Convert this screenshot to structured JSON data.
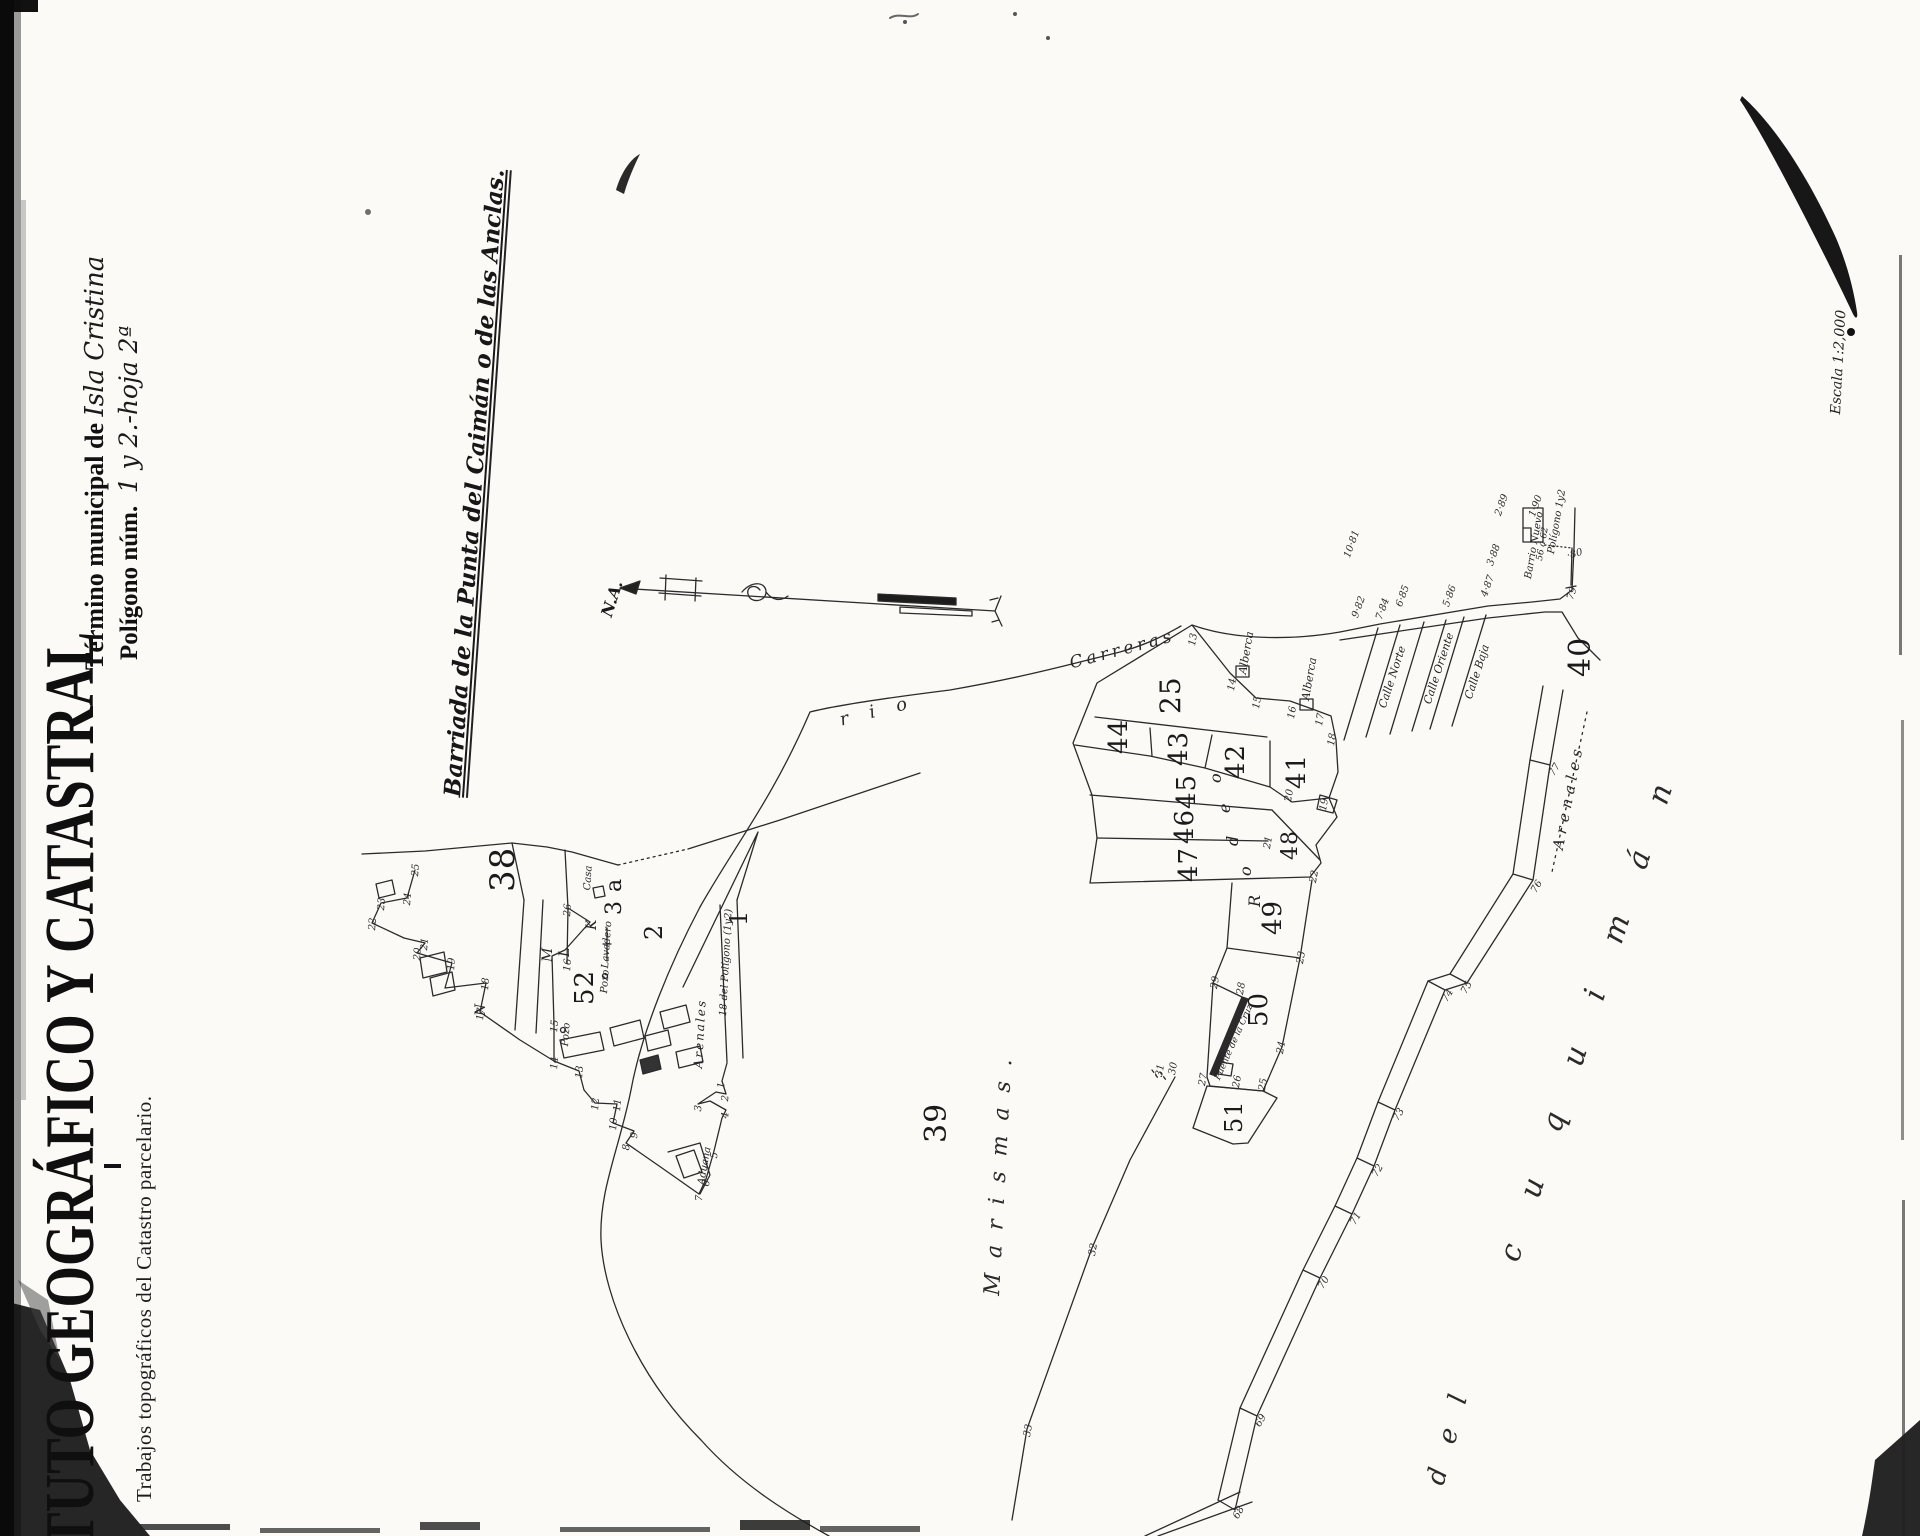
{
  "header": {
    "institute_title_partial": "TUTO GEOGRÁFICO Y CATASTRAL",
    "institute_subtitle": "Trabajos topográficos del Catastro parcelario.",
    "municipality_label": "Término municipal de ",
    "municipality_value": "Isla Cristina",
    "polygon_label": "Polígono núm.  ",
    "polygon_value": "1 y 2.-hoja 2ª",
    "map_area_title": "Barriada de la Punta del Caimán o de las Anclas.",
    "scale_note": "Escala 1:2,000",
    "north_label": "N.A."
  },
  "river": {
    "name_part1": "rio",
    "name_part2": "Carreras"
  },
  "street_names": [
    "Calle Norte",
    "Calle Oriente",
    "Calle Baja"
  ],
  "area_names": [
    "Marismas.",
    "Arenales",
    "del",
    "cuquimán"
  ],
  "labels": [
    {
      "name": "parcel-number-38",
      "text": "38",
      "x": 486,
      "y": 892,
      "rot": -90,
      "fs": 34,
      "cls": "parcel"
    },
    {
      "name": "parcel-number-52",
      "text": "52",
      "x": 572,
      "y": 1005,
      "rot": -90,
      "fs": 26,
      "cls": "parcel"
    },
    {
      "name": "parcel-number-2",
      "text": "2",
      "x": 642,
      "y": 940,
      "rot": -90,
      "fs": 24,
      "cls": "parcel"
    },
    {
      "name": "parcel-number-1",
      "text": "1",
      "x": 727,
      "y": 926,
      "rot": -90,
      "fs": 24,
      "cls": "parcel"
    },
    {
      "name": "parcel-number-3a",
      "text": "3 a",
      "x": 604,
      "y": 915,
      "rot": -90,
      "fs": 22,
      "cls": "parcel"
    },
    {
      "name": "parcel-number-39",
      "text": "39",
      "x": 922,
      "y": 1143,
      "rot": -90,
      "fs": 30,
      "cls": "parcel"
    },
    {
      "name": "parcel-number-25",
      "text": "25",
      "x": 1157,
      "y": 714,
      "rot": -90,
      "fs": 28,
      "cls": "parcel"
    },
    {
      "name": "parcel-number-44",
      "text": "44",
      "x": 1106,
      "y": 754,
      "rot": -90,
      "fs": 26,
      "cls": "parcel"
    },
    {
      "name": "parcel-number-43",
      "text": "43",
      "x": 1166,
      "y": 766,
      "rot": -90,
      "fs": 26,
      "cls": "parcel"
    },
    {
      "name": "parcel-number-42",
      "text": "42",
      "x": 1223,
      "y": 779,
      "rot": -90,
      "fs": 26,
      "cls": "parcel"
    },
    {
      "name": "parcel-number-41",
      "text": "41",
      "x": 1284,
      "y": 789,
      "rot": -90,
      "fs": 26,
      "cls": "parcel"
    },
    {
      "name": "parcel-number-45",
      "text": "45",
      "x": 1174,
      "y": 809,
      "rot": -90,
      "fs": 26,
      "cls": "parcel"
    },
    {
      "name": "parcel-number-46",
      "text": "46",
      "x": 1172,
      "y": 844,
      "rot": -90,
      "fs": 26,
      "cls": "parcel"
    },
    {
      "name": "parcel-number-47",
      "text": "47",
      "x": 1176,
      "y": 882,
      "rot": -90,
      "fs": 26,
      "cls": "parcel"
    },
    {
      "name": "parcel-number-48",
      "text": "48",
      "x": 1280,
      "y": 860,
      "rot": -90,
      "fs": 22,
      "cls": "parcel"
    },
    {
      "name": "parcel-number-49",
      "text": "49",
      "x": 1260,
      "y": 935,
      "rot": -90,
      "fs": 26,
      "cls": "parcel"
    },
    {
      "name": "parcel-number-50",
      "text": "50",
      "x": 1246,
      "y": 1027,
      "rot": -90,
      "fs": 26,
      "cls": "parcel"
    },
    {
      "name": "parcel-number-51",
      "text": "51",
      "x": 1222,
      "y": 1133,
      "rot": -90,
      "fs": 24,
      "cls": "parcel"
    },
    {
      "name": "parcel-number-40",
      "text": "40",
      "x": 1566,
      "y": 677,
      "rot": -90,
      "fs": 30,
      "cls": "parcel"
    },
    {
      "name": "subparcel-letter-o",
      "text": "o",
      "x": 1208,
      "y": 783,
      "rot": -90,
      "fs": 16,
      "cls": "letter"
    },
    {
      "name": "subparcel-letter-e",
      "text": "e",
      "x": 1217,
      "y": 813,
      "rot": -90,
      "fs": 16,
      "cls": "letter"
    },
    {
      "name": "subparcel-letter-d",
      "text": "d",
      "x": 1225,
      "y": 846,
      "rot": -90,
      "fs": 16,
      "cls": "letter"
    },
    {
      "name": "subparcel-letter-o2",
      "text": "o",
      "x": 1238,
      "y": 876,
      "rot": -90,
      "fs": 16,
      "cls": "letter"
    },
    {
      "name": "subparcel-letter-R",
      "text": "R",
      "x": 1247,
      "y": 907,
      "rot": -90,
      "fs": 16,
      "cls": "letter"
    },
    {
      "name": "corner-letter-K",
      "text": "K",
      "x": 585,
      "y": 930,
      "rot": -90,
      "fs": 14,
      "cls": "letter"
    },
    {
      "name": "corner-letter-L",
      "text": "L",
      "x": 558,
      "y": 957,
      "rot": -90,
      "fs": 14,
      "cls": "letter"
    },
    {
      "name": "corner-letter-M",
      "text": "M",
      "x": 541,
      "y": 962,
      "rot": -90,
      "fs": 14,
      "cls": "letter"
    },
    {
      "name": "corner-letter-N",
      "text": "N",
      "x": 474,
      "y": 1016,
      "rot": -90,
      "fs": 14,
      "cls": "letter"
    },
    {
      "name": "river-name-rio",
      "text": "r i o",
      "x": 838,
      "y": 712,
      "rot": -14,
      "fs": 18,
      "ls": 8,
      "cls": "spread"
    },
    {
      "name": "river-name-carreras",
      "text": "Carreras",
      "x": 1068,
      "y": 656,
      "rot": -15,
      "fs": 17,
      "ls": 4,
      "cls": "spread"
    },
    {
      "name": "area-marismas",
      "text": "Marismas.",
      "x": 982,
      "y": 1295,
      "rot": -87,
      "fs": 22,
      "ls": 15,
      "cls": "spread"
    },
    {
      "name": "area-arenales-road",
      "text": "Arenales",
      "x": 1551,
      "y": 848,
      "rot": -79,
      "fs": 15,
      "ls": 5,
      "cls": "spread"
    },
    {
      "name": "street-arenales-village",
      "text": "Arenales",
      "x": 692,
      "y": 1068,
      "rot": -87,
      "fs": 12,
      "ls": 2,
      "cls": "place"
    },
    {
      "name": "area-del",
      "text": "del",
      "x": 1423,
      "y": 1481,
      "rot": -75,
      "fs": 26,
      "ls": 26,
      "cls": "spread"
    },
    {
      "name": "area-cuquiman",
      "text": "cuquimán",
      "x": 1495,
      "y": 1256,
      "rot": -72,
      "fs": 30,
      "ls": 50,
      "cls": "spread"
    },
    {
      "name": "label-alberca-1",
      "text": "Alberca",
      "x": 1237,
      "y": 673,
      "rot": -80,
      "fs": 11,
      "cls": "place"
    },
    {
      "name": "label-alberca-2",
      "text": "Alberca",
      "x": 1300,
      "y": 699,
      "rot": -80,
      "fs": 11,
      "cls": "place"
    },
    {
      "name": "label-casa",
      "text": "Casa",
      "x": 583,
      "y": 890,
      "rot": -86,
      "fs": 10,
      "cls": "place"
    },
    {
      "name": "label-pozo-1",
      "text": "Pozo",
      "x": 600,
      "y": 993,
      "rot": -86,
      "fs": 10,
      "cls": "place"
    },
    {
      "name": "label-pozo-2",
      "text": "Pozo",
      "x": 561,
      "y": 1046,
      "rot": -86,
      "fs": 10,
      "cls": "place"
    },
    {
      "name": "label-lavadero",
      "text": "Lavadero",
      "x": 601,
      "y": 968,
      "rot": -86,
      "fs": 10,
      "cls": "place"
    },
    {
      "name": "label-aduana",
      "text": "Aduana",
      "x": 697,
      "y": 1184,
      "rot": -80,
      "fs": 10,
      "cls": "place"
    },
    {
      "name": "label-road-poligono",
      "text": "18 del Polígono (1y2)",
      "x": 719,
      "y": 1016,
      "rot": -87,
      "fs": 10,
      "cls": "place"
    },
    {
      "name": "label-barrio-nuevo",
      "text": "Barrio Nuevo",
      "x": 1524,
      "y": 578,
      "rot": -80,
      "fs": 10,
      "cls": "place"
    },
    {
      "name": "label-barrio-range",
      "text": "56 á 62",
      "x": 1536,
      "y": 560,
      "rot": -80,
      "fs": 9,
      "cls": "place"
    },
    {
      "name": "label-barrio-poligono",
      "text": "Polígono 1y2",
      "x": 1547,
      "y": 553,
      "rot": -80,
      "fs": 10,
      "cls": "place"
    },
    {
      "name": "label-pier",
      "text": "Puente de la Cruz",
      "x": 1214,
      "y": 1078,
      "rot": -66,
      "fs": 9,
      "cls": "place"
    },
    {
      "name": "street-calle-norte",
      "text": "Calle Norte",
      "x": 1377,
      "y": 706,
      "rot": -72,
      "fs": 11,
      "cls": "place"
    },
    {
      "name": "street-calle-oriente",
      "text": "Calle Oriente",
      "x": 1422,
      "y": 702,
      "rot": -72,
      "fs": 11,
      "cls": "place"
    },
    {
      "name": "street-calle-baja",
      "text": "Calle Baja",
      "x": 1463,
      "y": 697,
      "rot": -72,
      "fs": 11,
      "cls": "place"
    },
    {
      "name": "road-point-10-81",
      "text": "10·81",
      "x": 1343,
      "y": 556,
      "rot": -70,
      "fs": 10,
      "cls": "vnum"
    },
    {
      "name": "road-point-9-82",
      "text": "9·82",
      "x": 1351,
      "y": 616,
      "rot": -70,
      "fs": 10,
      "cls": "vnum"
    },
    {
      "name": "road-point-7-84",
      "text": "7·84",
      "x": 1375,
      "y": 618,
      "rot": -70,
      "fs": 10,
      "cls": "vnum"
    },
    {
      "name": "road-point-6-85",
      "text": "6·85",
      "x": 1395,
      "y": 605,
      "rot": -70,
      "fs": 10,
      "cls": "vnum"
    },
    {
      "name": "road-point-5-86",
      "text": "5·86",
      "x": 1442,
      "y": 605,
      "rot": -70,
      "fs": 10,
      "cls": "vnum"
    },
    {
      "name": "road-point-4-87",
      "text": "4·87",
      "x": 1480,
      "y": 595,
      "rot": -70,
      "fs": 10,
      "cls": "vnum"
    },
    {
      "name": "road-point-3-88",
      "text": "3·88",
      "x": 1486,
      "y": 564,
      "rot": -70,
      "fs": 10,
      "cls": "vnum"
    },
    {
      "name": "road-point-2-89",
      "text": "2·89",
      "x": 1494,
      "y": 514,
      "rot": -70,
      "fs": 10,
      "cls": "vnum"
    },
    {
      "name": "road-point-1-90",
      "text": "1·90",
      "x": 1528,
      "y": 515,
      "rot": -70,
      "fs": 10,
      "cls": "vnum"
    },
    {
      "name": "road-point-80",
      "text": "·80",
      "x": 1566,
      "y": 552,
      "rot": -15,
      "fs": 10,
      "cls": "vnum"
    },
    {
      "name": "road-point-79",
      "text": "79",
      "x": 1566,
      "y": 598,
      "rot": -70,
      "fs": 10,
      "cls": "vnum"
    },
    {
      "name": "road-point-77",
      "text": "77",
      "x": 1548,
      "y": 773,
      "rot": -60,
      "fs": 10,
      "cls": "vnum"
    },
    {
      "name": "road-point-76",
      "text": "76",
      "x": 1530,
      "y": 890,
      "rot": -60,
      "fs": 10,
      "cls": "vnum"
    },
    {
      "name": "road-point-75",
      "text": "75",
      "x": 1460,
      "y": 991,
      "rot": -60,
      "fs": 10,
      "cls": "vnum"
    },
    {
      "name": "road-point-74",
      "text": "74",
      "x": 1441,
      "y": 999,
      "rot": -60,
      "fs": 10,
      "cls": "vnum"
    },
    {
      "name": "road-point-73",
      "text": "73",
      "x": 1392,
      "y": 1118,
      "rot": -60,
      "fs": 10,
      "cls": "vnum"
    },
    {
      "name": "road-point-72",
      "text": "72",
      "x": 1371,
      "y": 1174,
      "rot": -60,
      "fs": 10,
      "cls": "vnum"
    },
    {
      "name": "road-point-71",
      "text": "71",
      "x": 1349,
      "y": 1222,
      "rot": -60,
      "fs": 10,
      "cls": "vnum"
    },
    {
      "name": "road-point-70",
      "text": "70",
      "x": 1317,
      "y": 1286,
      "rot": -60,
      "fs": 10,
      "cls": "vnum"
    },
    {
      "name": "road-point-69",
      "text": "69",
      "x": 1254,
      "y": 1424,
      "rot": -60,
      "fs": 10,
      "cls": "vnum"
    },
    {
      "name": "road-point-68",
      "text": "68",
      "x": 1232,
      "y": 1516,
      "rot": -60,
      "fs": 10,
      "cls": "vnum"
    },
    {
      "name": "vertex-13",
      "text": "13",
      "x": 1188,
      "y": 645,
      "rot": -80,
      "fs": 10,
      "cls": "vnum"
    },
    {
      "name": "vertex-14",
      "text": "14",
      "x": 1227,
      "y": 690,
      "rot": -80,
      "fs": 10,
      "cls": "vnum"
    },
    {
      "name": "vertex-15",
      "text": "15",
      "x": 1252,
      "y": 708,
      "rot": -80,
      "fs": 10,
      "cls": "vnum"
    },
    {
      "name": "vertex-16",
      "text": "16",
      "x": 1287,
      "y": 718,
      "rot": -80,
      "fs": 10,
      "cls": "vnum"
    },
    {
      "name": "vertex-17",
      "text": "17",
      "x": 1315,
      "y": 725,
      "rot": -80,
      "fs": 10,
      "cls": "vnum"
    },
    {
      "name": "vertex-18",
      "text": "18",
      "x": 1327,
      "y": 745,
      "rot": -80,
      "fs": 10,
      "cls": "vnum"
    },
    {
      "name": "vertex-20",
      "text": "20",
      "x": 1284,
      "y": 801,
      "rot": -80,
      "fs": 10,
      "cls": "vnum"
    },
    {
      "name": "vertex-19",
      "text": "19",
      "x": 1319,
      "y": 810,
      "rot": -80,
      "fs": 10,
      "cls": "vnum"
    },
    {
      "name": "vertex-21",
      "text": "21",
      "x": 1263,
      "y": 848,
      "rot": -80,
      "fs": 10,
      "cls": "vnum"
    },
    {
      "name": "vertex-22",
      "text": "22",
      "x": 1309,
      "y": 882,
      "rot": -80,
      "fs": 10,
      "cls": "vnum"
    },
    {
      "name": "vertex-23",
      "text": "23",
      "x": 1296,
      "y": 963,
      "rot": -80,
      "fs": 10,
      "cls": "vnum"
    },
    {
      "name": "vertex-24",
      "text": "24",
      "x": 1276,
      "y": 1053,
      "rot": -80,
      "fs": 10,
      "cls": "vnum"
    },
    {
      "name": "vertex-25",
      "text": "25",
      "x": 1258,
      "y": 1090,
      "rot": -80,
      "fs": 10,
      "cls": "vnum"
    },
    {
      "name": "vertex-26",
      "text": "26",
      "x": 1232,
      "y": 1087,
      "rot": -80,
      "fs": 10,
      "cls": "vnum"
    },
    {
      "name": "vertex-27",
      "text": "27",
      "x": 1198,
      "y": 1085,
      "rot": -80,
      "fs": 10,
      "cls": "vnum"
    },
    {
      "name": "vertex-28",
      "text": "28",
      "x": 1236,
      "y": 994,
      "rot": -80,
      "fs": 10,
      "cls": "vnum"
    },
    {
      "name": "vertex-29",
      "text": "29",
      "x": 1210,
      "y": 988,
      "rot": -80,
      "fs": 10,
      "cls": "vnum"
    },
    {
      "name": "vertex-30",
      "text": "30",
      "x": 1168,
      "y": 1074,
      "rot": -80,
      "fs": 10,
      "cls": "vnum"
    },
    {
      "name": "vertex-31",
      "text": "31",
      "x": 1155,
      "y": 1076,
      "rot": -80,
      "fs": 10,
      "cls": "vnum"
    },
    {
      "name": "vertex-32",
      "text": "32",
      "x": 1088,
      "y": 1255,
      "rot": -80,
      "fs": 10,
      "cls": "vnum"
    },
    {
      "name": "vertex-33",
      "text": "33",
      "x": 1023,
      "y": 1436,
      "rot": -80,
      "fs": 10,
      "cls": "vnum"
    },
    {
      "name": "village-vertex-25",
      "text": "25",
      "x": 411,
      "y": 876,
      "rot": -85,
      "fs": 10,
      "cls": "vnum"
    },
    {
      "name": "village-vertex-24",
      "text": "24",
      "x": 403,
      "y": 905,
      "rot": -85,
      "fs": 10,
      "cls": "vnum"
    },
    {
      "name": "village-vertex-23",
      "text": "23",
      "x": 377,
      "y": 910,
      "rot": -85,
      "fs": 10,
      "cls": "vnum"
    },
    {
      "name": "village-vertex-22",
      "text": "22",
      "x": 368,
      "y": 930,
      "rot": -85,
      "fs": 10,
      "cls": "vnum"
    },
    {
      "name": "village-vertex-21",
      "text": "21",
      "x": 420,
      "y": 950,
      "rot": -85,
      "fs": 10,
      "cls": "vnum"
    },
    {
      "name": "village-vertex-20",
      "text": "20",
      "x": 413,
      "y": 960,
      "rot": -85,
      "fs": 10,
      "cls": "vnum"
    },
    {
      "name": "village-vertex-19",
      "text": "19",
      "x": 447,
      "y": 970,
      "rot": -85,
      "fs": 10,
      "cls": "vnum"
    },
    {
      "name": "village-vertex-18",
      "text": "18",
      "x": 481,
      "y": 990,
      "rot": -85,
      "fs": 10,
      "cls": "vnum"
    },
    {
      "name": "village-vertex-17",
      "text": "17",
      "x": 476,
      "y": 1020,
      "rot": -85,
      "fs": 10,
      "cls": "vnum"
    },
    {
      "name": "village-vertex-26",
      "text": "26",
      "x": 563,
      "y": 916,
      "rot": -85,
      "fs": 10,
      "cls": "vnum"
    },
    {
      "name": "village-vertex-16",
      "text": "16",
      "x": 563,
      "y": 971,
      "rot": -85,
      "fs": 10,
      "cls": "vnum"
    },
    {
      "name": "village-vertex-15",
      "text": "15",
      "x": 550,
      "y": 1032,
      "rot": -85,
      "fs": 10,
      "cls": "vnum"
    },
    {
      "name": "village-vertex-14",
      "text": "14",
      "x": 550,
      "y": 1069,
      "rot": -85,
      "fs": 10,
      "cls": "vnum"
    },
    {
      "name": "village-vertex-13",
      "text": "13",
      "x": 575,
      "y": 1078,
      "rot": -85,
      "fs": 10,
      "cls": "vnum"
    },
    {
      "name": "village-vertex-12",
      "text": "12",
      "x": 591,
      "y": 1110,
      "rot": -85,
      "fs": 10,
      "cls": "vnum"
    },
    {
      "name": "village-vertex-11",
      "text": "11",
      "x": 613,
      "y": 1111,
      "rot": -85,
      "fs": 10,
      "cls": "vnum"
    },
    {
      "name": "village-vertex-10",
      "text": "10",
      "x": 609,
      "y": 1130,
      "rot": -85,
      "fs": 10,
      "cls": "vnum"
    },
    {
      "name": "village-vertex-9",
      "text": "9",
      "x": 630,
      "y": 1138,
      "rot": -85,
      "fs": 10,
      "cls": "vnum"
    },
    {
      "name": "village-vertex-8",
      "text": "8",
      "x": 622,
      "y": 1150,
      "rot": -85,
      "fs": 10,
      "cls": "vnum"
    },
    {
      "name": "village-vertex-7",
      "text": "7",
      "x": 695,
      "y": 1201,
      "rot": -85,
      "fs": 10,
      "cls": "vnum"
    },
    {
      "name": "village-vertex-6",
      "text": "6",
      "x": 702,
      "y": 1186,
      "rot": -85,
      "fs": 10,
      "cls": "vnum"
    },
    {
      "name": "village-vertex-5",
      "text": "5",
      "x": 710,
      "y": 1158,
      "rot": -85,
      "fs": 10,
      "cls": "vnum"
    },
    {
      "name": "village-vertex-4",
      "text": "4",
      "x": 721,
      "y": 1118,
      "rot": -85,
      "fs": 10,
      "cls": "vnum"
    },
    {
      "name": "village-vertex-3",
      "text": "3",
      "x": 694,
      "y": 1111,
      "rot": -85,
      "fs": 10,
      "cls": "vnum"
    },
    {
      "name": "village-vertex-2",
      "text": "2",
      "x": 721,
      "y": 1101,
      "rot": -85,
      "fs": 10,
      "cls": "vnum"
    },
    {
      "name": "village-vertex-1",
      "text": "1",
      "x": 717,
      "y": 1088,
      "rot": -85,
      "fs": 10,
      "cls": "vnum"
    }
  ]
}
